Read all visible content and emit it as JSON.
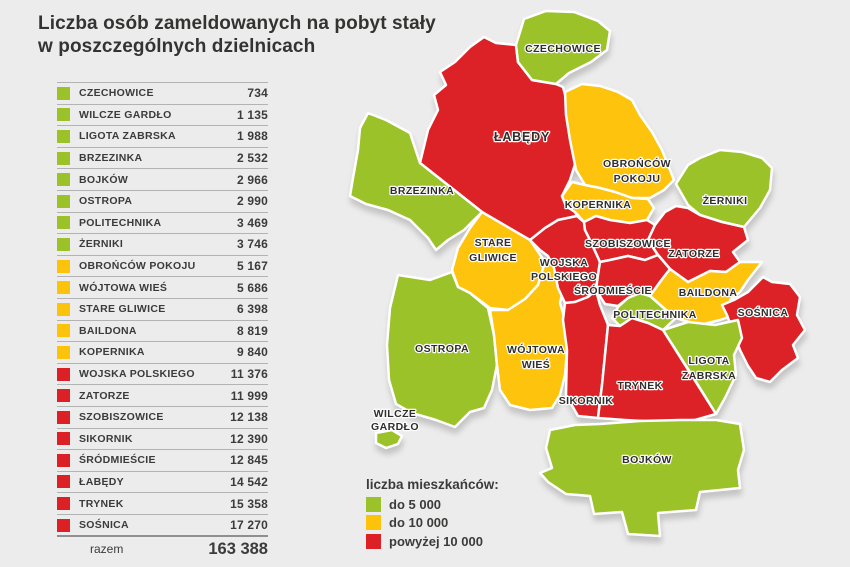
{
  "title": {
    "line1": "Liczba osób zameldowanych na pobyt stały",
    "line2": "w poszczególnych dzielnicach"
  },
  "table": {
    "rows": [
      {
        "name": "CZECHOWICE",
        "value": "734",
        "category": "green"
      },
      {
        "name": "WILCZE GARDŁO",
        "value": "1 135",
        "category": "green"
      },
      {
        "name": "LIGOTA ZABRSKA",
        "value": "1 988",
        "category": "green"
      },
      {
        "name": "BRZEZINKA",
        "value": "2 532",
        "category": "green"
      },
      {
        "name": "BOJKÓW",
        "value": "2 966",
        "category": "green"
      },
      {
        "name": "OSTROPA",
        "value": "2 990",
        "category": "green"
      },
      {
        "name": "POLITECHNIKA",
        "value": "3 469",
        "category": "green"
      },
      {
        "name": "ŻERNIKI",
        "value": "3 746",
        "category": "green"
      },
      {
        "name": "OBROŃCÓW POKOJU",
        "value": "5 167",
        "category": "yellow"
      },
      {
        "name": "WÓJTOWA WIEŚ",
        "value": "5 686",
        "category": "yellow"
      },
      {
        "name": "STARE GLIWICE",
        "value": "6 398",
        "category": "yellow"
      },
      {
        "name": "BAILDONA",
        "value": "8 819",
        "category": "yellow"
      },
      {
        "name": "KOPERNIKA",
        "value": "9 840",
        "category": "yellow"
      },
      {
        "name": "WOJSKA POLSKIEGO",
        "value": "11 376",
        "category": "red"
      },
      {
        "name": "ZATORZE",
        "value": "11 999",
        "category": "red"
      },
      {
        "name": "SZOBISZOWICE",
        "value": "12 138",
        "category": "red"
      },
      {
        "name": "SIKORNIK",
        "value": "12 390",
        "category": "red"
      },
      {
        "name": "ŚRÓDMIEŚCIE",
        "value": "12 845",
        "category": "red"
      },
      {
        "name": "ŁABĘDY",
        "value": "14 542",
        "category": "red"
      },
      {
        "name": "TRYNEK",
        "value": "15 358",
        "category": "red"
      },
      {
        "name": "SOŚNICA",
        "value": "17 270",
        "category": "red"
      }
    ],
    "total_label": "razem",
    "total_value": "163 388"
  },
  "legend": {
    "title": "liczba mieszkańców:",
    "items": [
      {
        "label": "do 5 000",
        "category": "green"
      },
      {
        "label": "do 10 000",
        "category": "yellow"
      },
      {
        "label": "powyżej 10 000",
        "category": "red"
      }
    ]
  },
  "colors": {
    "green": "#9cc229",
    "yellow": "#fdc30b",
    "red": "#dc2026",
    "background": "#ececec",
    "shadow": "#c8c8c8",
    "text": "#3b3b3a"
  },
  "map": {
    "districts": [
      {
        "id": "labedy",
        "category": "red",
        "label_lines": [
          "ŁABĘDY"
        ]
      },
      {
        "id": "czechowice",
        "category": "green",
        "label_lines": [
          "CZECHOWICE"
        ]
      },
      {
        "id": "brzezinka",
        "category": "green",
        "label_lines": [
          "BRZEZINKA"
        ]
      },
      {
        "id": "obroncow-pokoju",
        "category": "yellow",
        "label_lines": [
          "OBROŃCÓW",
          "POKOJU"
        ]
      },
      {
        "id": "kopernika",
        "category": "yellow",
        "label_lines": [
          "KOPERNIKA"
        ]
      },
      {
        "id": "zerniki",
        "category": "green",
        "label_lines": [
          "ŻERNIKI"
        ]
      },
      {
        "id": "stare-gliwice",
        "category": "yellow",
        "label_lines": [
          "STARE",
          "GLIWICE"
        ]
      },
      {
        "id": "ostropa",
        "category": "green",
        "label_lines": [
          "OSTROPA"
        ]
      },
      {
        "id": "wilcze-gardlo",
        "category": "green",
        "label_lines": [
          "WILCZE",
          "GARDŁO"
        ]
      },
      {
        "id": "wojtowa-wies",
        "category": "yellow",
        "label_lines": [
          "WÓJTOWA",
          "WIEŚ"
        ]
      },
      {
        "id": "wojska-polskiego",
        "category": "red",
        "label_lines": [
          "WOJSKA",
          "POLSKIEGO"
        ]
      },
      {
        "id": "szobiszowice",
        "category": "red",
        "label_lines": [
          "SZOBISZOWICE"
        ]
      },
      {
        "id": "zatorze",
        "category": "red",
        "label_lines": [
          "ZATORZE"
        ]
      },
      {
        "id": "srodmiescie",
        "category": "red",
        "label_lines": [
          "ŚRÓDMIEŚCIE"
        ]
      },
      {
        "id": "baildona",
        "category": "yellow",
        "label_lines": [
          "BAILDONA"
        ]
      },
      {
        "id": "sosnica",
        "category": "red",
        "label_lines": [
          "SOŚNICA"
        ]
      },
      {
        "id": "politechnika",
        "category": "green",
        "label_lines": [
          "POLITECHNIKA"
        ]
      },
      {
        "id": "sikornik",
        "category": "red",
        "label_lines": [
          "SIKORNIK"
        ]
      },
      {
        "id": "trynek",
        "category": "red",
        "label_lines": [
          "TRYNEK"
        ]
      },
      {
        "id": "ligota-zabrska",
        "category": "green",
        "label_lines": [
          "LIGOTA",
          "ZABRSKA"
        ]
      },
      {
        "id": "bojkow",
        "category": "green",
        "label_lines": [
          "BOJKÓW"
        ]
      }
    ]
  },
  "chart_data": {
    "type": "table",
    "title": "Liczba osób zameldowanych na pobyt stały w poszczególnych dzielnicach",
    "categories": [
      "CZECHOWICE",
      "WILCZE GARDŁO",
      "LIGOTA ZABRSKA",
      "BRZEZINKA",
      "BOJKÓW",
      "OSTROPA",
      "POLITECHNIKA",
      "ŻERNIKI",
      "OBROŃCÓW POKOJU",
      "WÓJTOWA WIEŚ",
      "STARE GLIWICE",
      "BAILDONA",
      "KOPERNIKA",
      "WOJSKA POLSKIEGO",
      "ZATORZE",
      "SZOBISZOWICE",
      "SIKORNIK",
      "ŚRÓDMIEŚCIE",
      "ŁABĘDY",
      "TRYNEK",
      "SOŚNICA"
    ],
    "values": [
      734,
      1135,
      1988,
      2532,
      2966,
      2990,
      3469,
      3746,
      5167,
      5686,
      6398,
      8819,
      9840,
      11376,
      11999,
      12138,
      12390,
      12845,
      14542,
      15358,
      17270
    ],
    "total": 163388,
    "legend_position": "bottom-left",
    "buckets": {
      "green": "do 5 000",
      "yellow": "do 10 000",
      "red": "powyżej 10 000"
    }
  }
}
